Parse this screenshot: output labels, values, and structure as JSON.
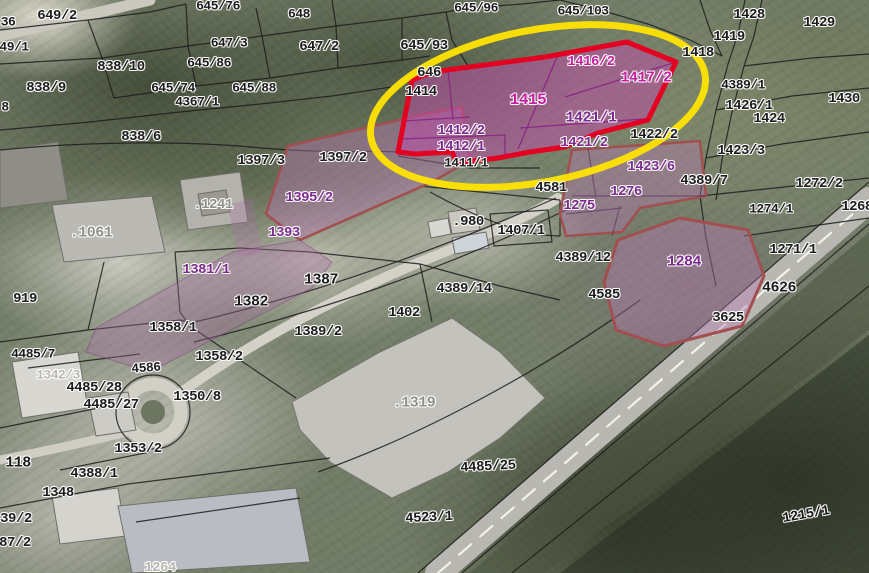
{
  "map": {
    "type": "cadastral-aerial-orthophoto",
    "highlight": {
      "red_outline_color": "#e30021",
      "yellow_ellipse_color": "#ffe400",
      "selected_fill_strong": "#c149aa",
      "selected_fill_light": "#ba78b4",
      "light_parcel_border": "#a14f4f"
    },
    "label_colors": {
      "black": "#1c1c1c",
      "magenta": "#c51fa0",
      "purple": "#7c2a8e",
      "gray": "#8f9089",
      "lightgray": "#bab7af"
    },
    "labels": [
      {
        "t": "649/2",
        "x": 57,
        "y": 16,
        "c": "black",
        "s": 14
      },
      {
        "t": "36",
        "x": 8,
        "y": 22,
        "c": "black"
      },
      {
        "t": "49/1",
        "x": 14,
        "y": 47,
        "c": "black"
      },
      {
        "t": "8",
        "x": 5,
        "y": 107,
        "c": "black"
      },
      {
        "t": "838/10",
        "x": 121,
        "y": 67,
        "c": "black",
        "s": 14
      },
      {
        "t": "838/9",
        "x": 46,
        "y": 88,
        "c": "black",
        "s": 14
      },
      {
        "t": "645/76",
        "x": 218,
        "y": 6,
        "c": "black"
      },
      {
        "t": "647/3",
        "x": 229,
        "y": 43,
        "c": "black"
      },
      {
        "t": "645/86",
        "x": 209,
        "y": 63,
        "c": "black"
      },
      {
        "t": "645/74",
        "x": 173,
        "y": 88,
        "c": "black"
      },
      {
        "t": "645/88",
        "x": 254,
        "y": 88,
        "c": "black"
      },
      {
        "t": "4367/1",
        "x": 197,
        "y": 102,
        "c": "black"
      },
      {
        "t": "838/6",
        "x": 141,
        "y": 137,
        "c": "black",
        "s": 14
      },
      {
        "t": "648",
        "x": 299,
        "y": 14,
        "c": "black"
      },
      {
        "t": "647/2",
        "x": 319,
        "y": 47,
        "c": "black",
        "s": 14
      },
      {
        "t": "645/93",
        "x": 424,
        "y": 46,
        "c": "black",
        "s": 14
      },
      {
        "t": "645/96",
        "x": 476,
        "y": 8,
        "c": "black"
      },
      {
        "t": "645/103",
        "x": 583,
        "y": 11,
        "c": "black"
      },
      {
        "t": "646",
        "x": 429,
        "y": 73,
        "c": "black",
        "s": 14
      },
      {
        "t": "1414",
        "x": 421,
        "y": 92,
        "c": "black",
        "s": 14
      },
      {
        "t": "1428",
        "x": 749,
        "y": 15,
        "c": "black",
        "s": 14
      },
      {
        "t": "1429",
        "x": 819,
        "y": 23,
        "c": "black",
        "s": 14
      },
      {
        "t": "1419",
        "x": 729,
        "y": 37,
        "c": "black",
        "s": 14
      },
      {
        "t": "1418",
        "x": 698,
        "y": 53,
        "c": "black",
        "s": 14
      },
      {
        "t": "4389/1",
        "x": 743,
        "y": 85,
        "c": "black"
      },
      {
        "t": "1426/1",
        "x": 749,
        "y": 106,
        "c": "black",
        "s": 14
      },
      {
        "t": "1430",
        "x": 844,
        "y": 99,
        "c": "black",
        "s": 14
      },
      {
        "t": "1424",
        "x": 769,
        "y": 119,
        "c": "black",
        "s": 14
      },
      {
        "t": "1423/3",
        "x": 741,
        "y": 151,
        "c": "black",
        "s": 14
      },
      {
        "t": "4389/7",
        "x": 704,
        "y": 181,
        "c": "black",
        "s": 14
      },
      {
        "t": "1272/2",
        "x": 819,
        "y": 184,
        "c": "black",
        "s": 14
      },
      {
        "t": "1274/1",
        "x": 771,
        "y": 209,
        "c": "black"
      },
      {
        "t": "1268",
        "x": 857,
        "y": 207,
        "c": "black",
        "s": 14
      },
      {
        "t": "1271/1",
        "x": 793,
        "y": 250,
        "c": "black",
        "s": 14
      },
      {
        "t": "4626",
        "x": 779,
        "y": 288,
        "c": "black",
        "s": 15
      },
      {
        "t": "3625",
        "x": 728,
        "y": 318,
        "c": "black",
        "s": 14
      },
      {
        "t": "4585",
        "x": 604,
        "y": 295,
        "c": "black",
        "s": 14
      },
      {
        "t": "4389/12",
        "x": 583,
        "y": 258,
        "c": "black",
        "s": 14
      },
      {
        "t": "4389/14",
        "x": 464,
        "y": 289,
        "c": "black",
        "s": 14
      },
      {
        "t": "4581",
        "x": 551,
        "y": 188,
        "c": "black",
        "s": 14
      },
      {
        "t": ".980",
        "x": 468,
        "y": 222,
        "c": "black",
        "s": 14
      },
      {
        "t": "1407/1",
        "x": 521,
        "y": 231,
        "c": "black",
        "s": 14
      },
      {
        "t": "1411/1",
        "x": 466,
        "y": 163,
        "c": "black"
      },
      {
        "t": "1397/3",
        "x": 261,
        "y": 161,
        "c": "black",
        "s": 14
      },
      {
        "t": "1397/2",
        "x": 343,
        "y": 158,
        "c": "black",
        "s": 14
      },
      {
        "t": "1387",
        "x": 321,
        "y": 280,
        "c": "black",
        "s": 15
      },
      {
        "t": "1382",
        "x": 251,
        "y": 302,
        "c": "black",
        "s": 15
      },
      {
        "t": "1402",
        "x": 404,
        "y": 313,
        "c": "black",
        "s": 14
      },
      {
        "t": "1389/2",
        "x": 318,
        "y": 332,
        "c": "black",
        "s": 14
      },
      {
        "t": "1358/1",
        "x": 173,
        "y": 328,
        "c": "black",
        "s": 14
      },
      {
        "t": "1358/2",
        "x": 219,
        "y": 357,
        "c": "black",
        "s": 14
      },
      {
        "t": "1350/8",
        "x": 197,
        "y": 397,
        "c": "black",
        "s": 14
      },
      {
        "t": "1353/2",
        "x": 138,
        "y": 449,
        "c": "black",
        "s": 14
      },
      {
        "t": "4388/1",
        "x": 94,
        "y": 474,
        "c": "black",
        "s": 14
      },
      {
        "t": "1348",
        "x": 58,
        "y": 493,
        "c": "black",
        "s": 14
      },
      {
        "t": "118",
        "x": 18,
        "y": 463,
        "c": "black",
        "s": 15
      },
      {
        "t": "919",
        "x": 25,
        "y": 299,
        "c": "black",
        "s": 14
      },
      {
        "t": "4485/7",
        "x": 33,
        "y": 354,
        "c": "black"
      },
      {
        "t": "4485/28",
        "x": 94,
        "y": 388,
        "c": "black",
        "s": 14
      },
      {
        "t": "4485/27",
        "x": 111,
        "y": 405,
        "c": "black",
        "s": 14
      },
      {
        "t": "4586",
        "x": 146,
        "y": 368,
        "c": "black",
        "r": -4
      },
      {
        "t": "4485/25",
        "x": 488,
        "y": 467,
        "c": "black",
        "s": 14,
        "r": -3
      },
      {
        "t": "4523/1",
        "x": 429,
        "y": 518,
        "c": "black",
        "s": 14,
        "r": -3
      },
      {
        "t": "1215/1",
        "x": 806,
        "y": 515,
        "c": "black",
        "s": 14,
        "r": -10
      },
      {
        "t": "439/2",
        "x": 12,
        "y": 519,
        "c": "black",
        "s": 14
      },
      {
        "t": "387/2",
        "x": 11,
        "y": 543,
        "c": "black",
        "s": 14
      },
      {
        "t": "1422/2",
        "x": 654,
        "y": 135,
        "c": "black",
        "s": 14
      },
      {
        "t": "1415",
        "x": 528,
        "y": 100,
        "c": "magenta",
        "s": 16
      },
      {
        "t": "1416/2",
        "x": 591,
        "y": 62,
        "c": "magenta",
        "s": 14
      },
      {
        "t": "1417/2",
        "x": 646,
        "y": 78,
        "c": "magenta",
        "s": 15
      },
      {
        "t": "1421/1",
        "x": 591,
        "y": 118,
        "c": "purple",
        "s": 15
      },
      {
        "t": "1412/2",
        "x": 461,
        "y": 131,
        "c": "purple",
        "s": 14
      },
      {
        "t": "1412/1",
        "x": 461,
        "y": 147,
        "c": "purple",
        "s": 14
      },
      {
        "t": "1421/2",
        "x": 584,
        "y": 143,
        "c": "purple",
        "s": 14
      },
      {
        "t": "1423/6",
        "x": 651,
        "y": 167,
        "c": "purple",
        "s": 14
      },
      {
        "t": "1276",
        "x": 626,
        "y": 192,
        "c": "purple",
        "s": 14
      },
      {
        "t": "1275",
        "x": 579,
        "y": 206,
        "c": "purple",
        "s": 14
      },
      {
        "t": "1284",
        "x": 684,
        "y": 262,
        "c": "purple",
        "s": 15
      },
      {
        "t": "1395/2",
        "x": 309,
        "y": 198,
        "c": "purple",
        "s": 14
      },
      {
        "t": "1393",
        "x": 284,
        "y": 233,
        "c": "purple",
        "s": 14
      },
      {
        "t": "1381/1",
        "x": 206,
        "y": 270,
        "c": "purple",
        "s": 14
      },
      {
        "t": ".1061",
        "x": 91,
        "y": 233,
        "c": "gray",
        "s": 15
      },
      {
        "t": ".1241",
        "x": 213,
        "y": 205,
        "c": "gray",
        "s": 14
      },
      {
        "t": "1342/3",
        "x": 58,
        "y": 375,
        "c": "lightgray"
      },
      {
        "t": ".1319",
        "x": 414,
        "y": 403,
        "c": "gray",
        "s": 15
      },
      {
        "t": "1264",
        "x": 160,
        "y": 568,
        "c": "lightgray",
        "s": 14
      }
    ]
  }
}
